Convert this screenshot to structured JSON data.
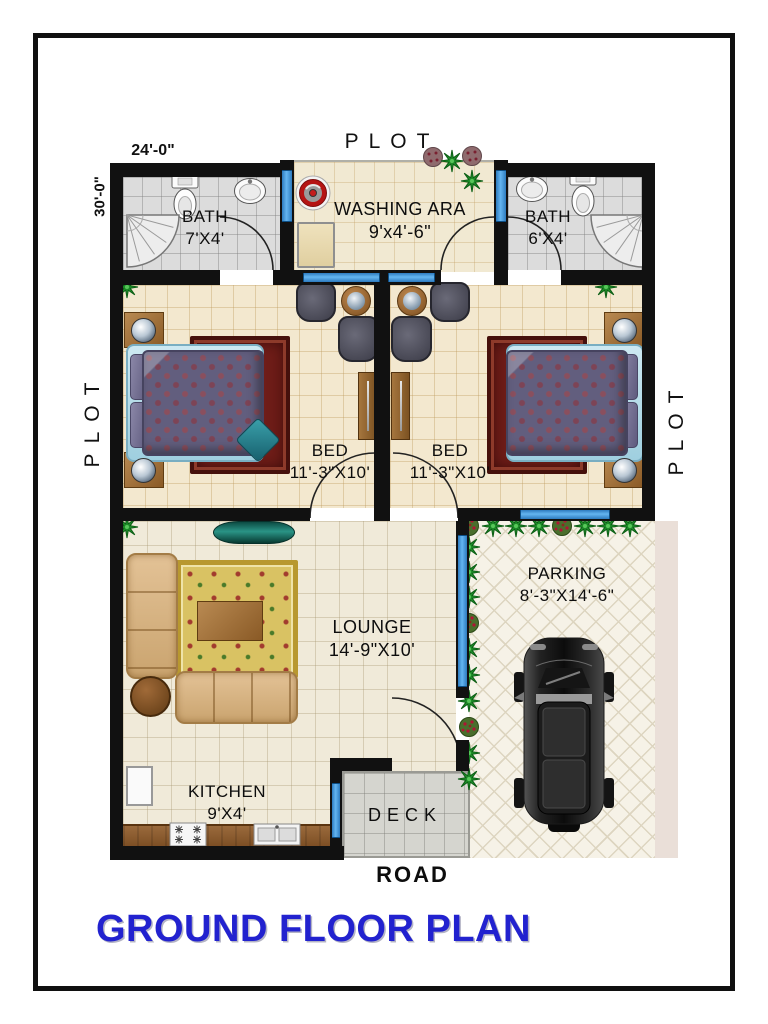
{
  "page": {
    "title": "GROUND FLOOR PLAN"
  },
  "context": {
    "plot_top": "PLOT",
    "plot_left": "PLOT",
    "plot_right": "PLOT",
    "road": "ROAD"
  },
  "dimensions": {
    "plot_width": "24'-0\"",
    "plot_depth": "30'-0\""
  },
  "rooms": {
    "bath_left": {
      "name": "BATH",
      "size": "7'X4'"
    },
    "washing_area": {
      "name": "WASHING ARA",
      "size": "9'x4'-6\""
    },
    "bath_right": {
      "name": "BATH",
      "size": "6'X4'"
    },
    "bed_left": {
      "name": "BED",
      "size": "11'-3\"X10'"
    },
    "bed_right": {
      "name": "BED",
      "size": "11'-3\"X10'"
    },
    "lounge": {
      "name": "LOUNGE",
      "size": "14'-9\"X10'"
    },
    "parking": {
      "name": "PARKING",
      "size": "8'-3\"X14'-6\""
    },
    "kitchen": {
      "name": "KITCHEN",
      "size": "9'X4'"
    },
    "deck": {
      "name": "DECK"
    }
  },
  "colors": {
    "title_blue": "#2222cf",
    "wall": "#111111",
    "window_blue": "#64b5f0",
    "hedge_green": "#1f8f2a",
    "floor_cream": "#f3e8cf",
    "floor_bath": "#dcdcdc",
    "floor_parking": "#f6f2e7",
    "floor_deck": "#d5d5cf",
    "rug_red": "#6f1d18",
    "rug_gold": "#d9c263",
    "sofa_tan": "#d9b585",
    "bed_quilt": "#625e7e",
    "car_body": "#1a1a1a"
  },
  "fixtures": {
    "bath_left": [
      "toilet",
      "wash-basin",
      "corner-shower"
    ],
    "washing_area": [
      "washing-machine",
      "laundry-unit",
      "shrubs"
    ],
    "bath_right": [
      "wash-basin",
      "toilet",
      "corner-shower"
    ],
    "bedrooms": [
      "double-bed",
      "bedside-tables",
      "lamps",
      "rug",
      "armchairs",
      "side-table",
      "wardrobe",
      "plant"
    ],
    "lounge": [
      "corner-sofa",
      "sofa",
      "rug",
      "coffee-table",
      "round-table",
      "console",
      "plant"
    ],
    "kitchen": [
      "counter",
      "stove",
      "sink",
      "refrigerator"
    ],
    "parking": [
      "car",
      "hedge-row"
    ]
  }
}
